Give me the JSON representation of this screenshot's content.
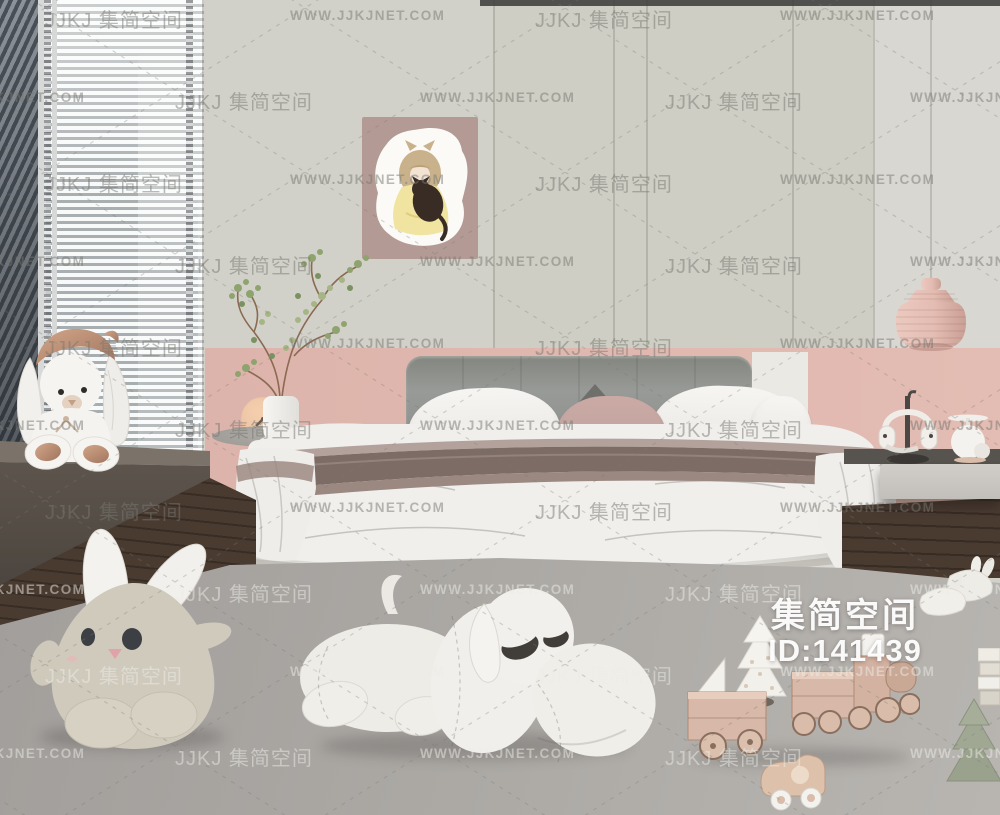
{
  "watermark": {
    "logo": "JJKJ 集简空间",
    "url": "WWW.JJKJNET.COM"
  },
  "id_overlay": {
    "brand": "集简空间",
    "id_text": "ID:141439"
  },
  "palette": {
    "wall": "#d2d1c9",
    "wall2": "#cfcec5",
    "wall3": "#d8d7d1",
    "pink": "#ddb4ab",
    "pink2": "#e3bcb3",
    "headboard": "#8f918f",
    "bench": "#5c544d",
    "wood": "#44362d",
    "rug": "#a9a6a2",
    "bed_base": "#d8d7d2",
    "duvet": "#f0efec",
    "blanket_stripe_dark": "#7d6c66",
    "blanket_stripe_mid": "#9b8880",
    "blanket_stripe_light": "#b3a29b",
    "lamp_pink": "#e5c0b7",
    "plush_white": "#f2f0ec",
    "plush_beige": "#d0cabd",
    "copper": "#bd8f76",
    "toy_wood": "#d8b8a7",
    "tree_green": "#9aa28e",
    "art_bg": "#b49a95"
  },
  "objects": {
    "window_blinds": "white venetian blinds with city haze",
    "wall_art": "girl hugging cat illustration",
    "pendant_lamp": "pink ribbed pendant lamp",
    "plant": "green branch plant in white vase",
    "clock": "peach round clock",
    "bed": "double bed with gray headboard and white duvet",
    "nightstand": "floating gray nightstand",
    "headphones": "white headphones on stand",
    "sill_bunny": "white bunny plush with copper hat",
    "floor_bunny": "beige round bunny plush",
    "dog_plush": "large white lying dog plush",
    "slippers": "white bunny slippers",
    "toy_wagon": "wooden toy wagon",
    "toy_train": "wooden toy train",
    "toy_car": "wooden toy car",
    "white_tree": "small white christmas tree",
    "green_tree": "green felt tree",
    "books": "stack of books"
  }
}
